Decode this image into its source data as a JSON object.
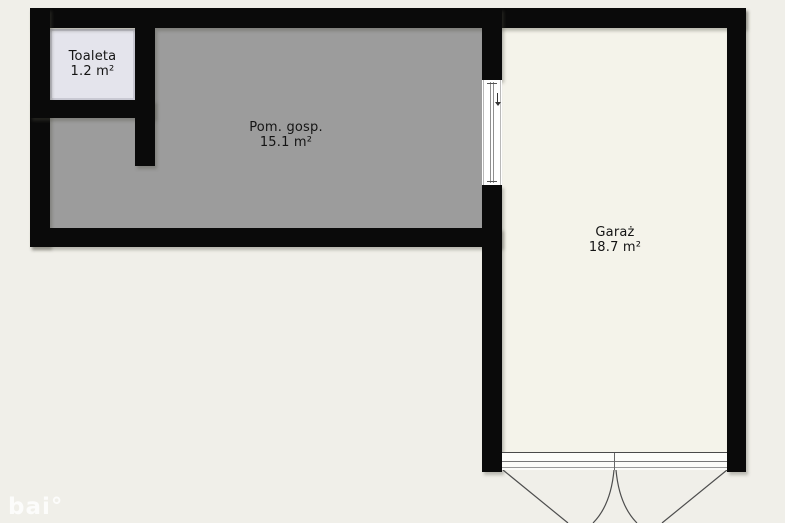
{
  "plan": {
    "rooms": [
      {
        "id": "toaleta",
        "name": "Toaleta",
        "area": "1.2 m²"
      },
      {
        "id": "pom_gosp",
        "name": "Pom. gosp.",
        "area": "15.1 m²"
      },
      {
        "id": "garaz",
        "name": "Garaż",
        "area": "18.7 m²"
      }
    ],
    "watermark": "bai°",
    "colors": {
      "background": "#f0efe9",
      "wall": "#0a0a0a",
      "garage_floor": "#f4f3ea",
      "utility_floor": "#9c9c9c",
      "toilet_floor": "#e4e4ec",
      "opening": "#ffffff",
      "label_text": "#141414"
    }
  }
}
